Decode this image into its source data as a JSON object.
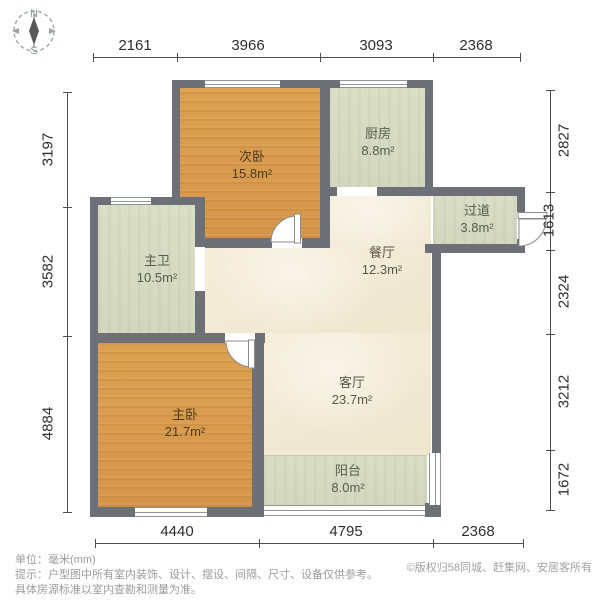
{
  "compass": {
    "north": "N",
    "south": "S"
  },
  "dims": {
    "top": [
      "2161",
      "3966",
      "3093",
      "2368"
    ],
    "left": [
      "3197",
      "3582",
      "4884"
    ],
    "right": [
      "2827",
      "1613",
      "2324",
      "3212",
      "1672"
    ],
    "bottom": [
      "4440",
      "4795",
      "2368"
    ]
  },
  "rooms": {
    "secondary_bedroom": {
      "name": "次卧",
      "area": "15.8m²"
    },
    "kitchen": {
      "name": "厨房",
      "area": "8.8m²"
    },
    "hallway": {
      "name": "过道",
      "area": "3.8m²"
    },
    "master_bathroom": {
      "name": "主卫",
      "area": "10.5m²"
    },
    "dining_room": {
      "name": "餐厅",
      "area": "12.3m²"
    },
    "living_room": {
      "name": "客厅",
      "area": "23.7m²"
    },
    "master_bedroom": {
      "name": "主卧",
      "area": "21.7m²"
    },
    "balcony": {
      "name": "阳台",
      "area": "8.0m²"
    }
  },
  "footer": {
    "unit_line": "单位：毫米(mm)",
    "tip_line1": "提示：户型图中所有室内装饰、设计、摆设、间隔、尺寸、设备仅供参考。",
    "tip_line2": "具体房源标准以室内查勘和测量为准。",
    "copyright": "©版权归58同城、赶集网、安居客所有"
  },
  "colors": {
    "wall": "#6d7077",
    "bedroom_floor": "#d9994d",
    "tile_floor": "#d8dcc4",
    "living_floor": "#f3ecd8"
  }
}
